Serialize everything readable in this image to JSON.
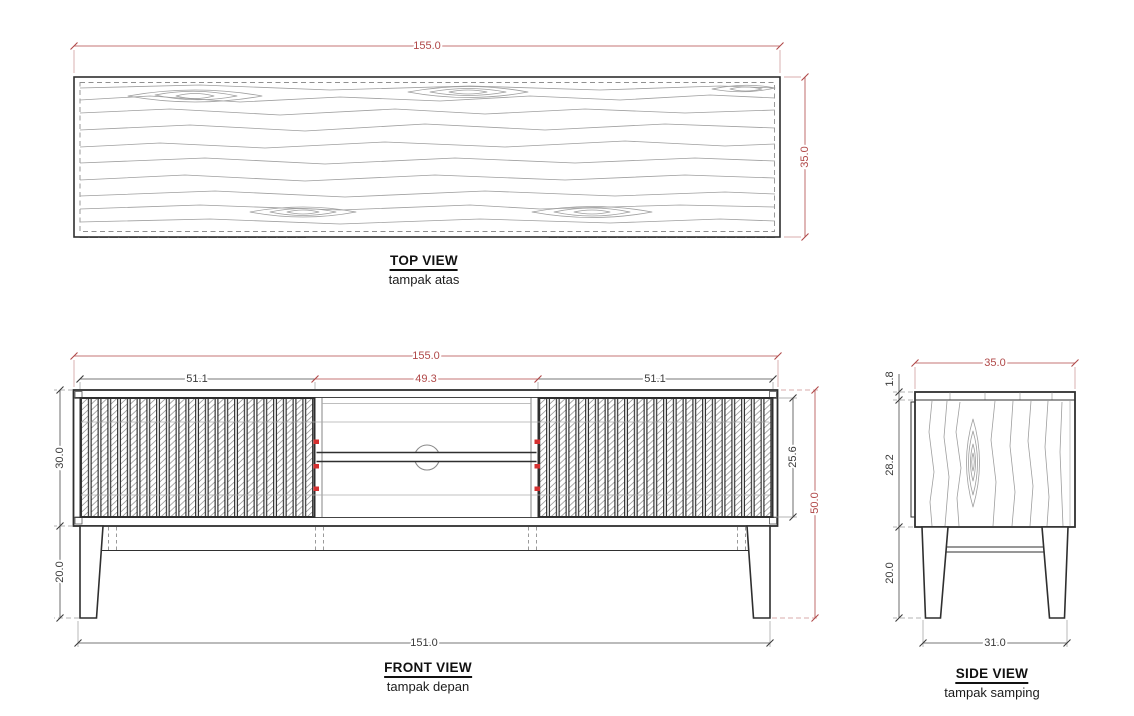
{
  "drawing": {
    "colors": {
      "accent_red": "#b04848",
      "marker_red": "#d43030",
      "ink": "#2f2f2f",
      "grain": "#9e9e9e"
    },
    "views": {
      "top": {
        "title": "TOP VIEW",
        "subtitle": "tampak atas",
        "dim_width": "155.0",
        "dim_depth": "35.0"
      },
      "front": {
        "title": "FRONT VIEW",
        "subtitle": "tampak depan",
        "dim_overall_width": "155.0",
        "dim_left_door_width": "51.1",
        "dim_middle_width": "49.3",
        "dim_right_door_width": "51.1",
        "dim_body_height": "30.0",
        "dim_leg_height": "20.0",
        "dim_door_height": "25.6",
        "dim_overall_height": "50.0",
        "dim_leg_span": "151.0"
      },
      "side": {
        "title": "SIDE VIEW",
        "subtitle": "tampak samping",
        "dim_depth": "35.0",
        "dim_top_thickness": "1.8",
        "dim_body_height": "28.2",
        "dim_leg_height": "20.0",
        "dim_leg_span": "31.0"
      }
    }
  }
}
